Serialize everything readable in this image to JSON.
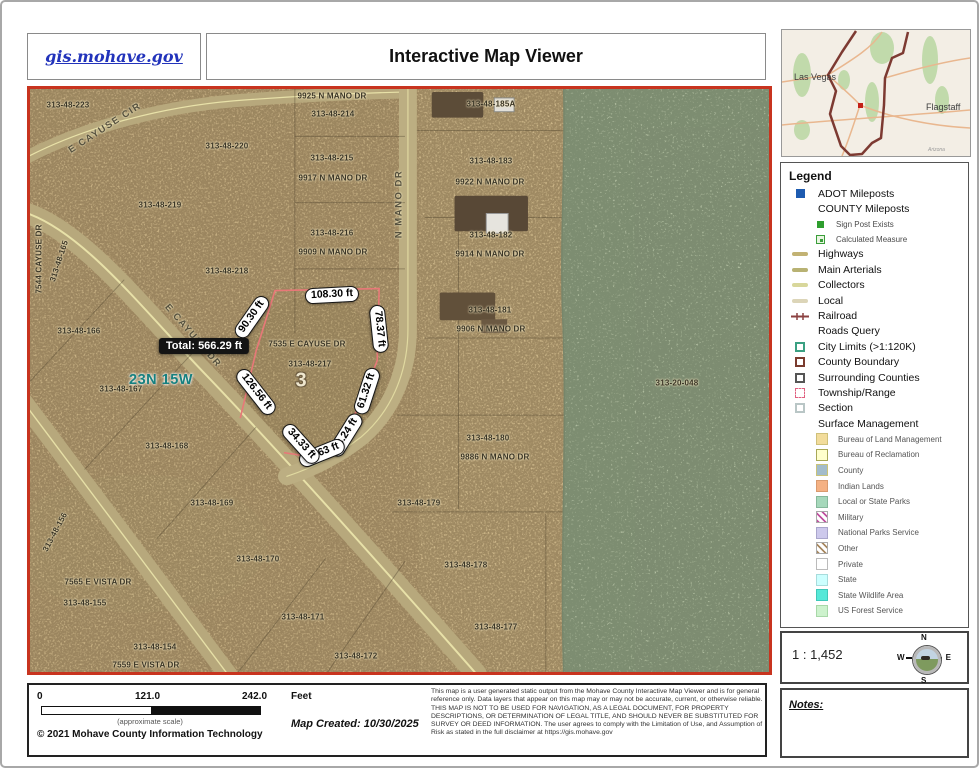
{
  "header": {
    "site_link": "gis.mohave.gov",
    "title": "Interactive Map Viewer"
  },
  "colors": {
    "map_border": "#c8341f",
    "measure_line": "#e87878",
    "link_blue": "#2233bb",
    "green_zone": "#b7c3a6",
    "township_teal": "#17807f"
  },
  "overview": {
    "las_vegas": "Las Vegas",
    "flagstaff": "Flagstaff",
    "state_note": "Arizona"
  },
  "map": {
    "township_label": "23N 15W",
    "section_number": "3",
    "measure": {
      "total": "Total: 566.29 ft",
      "segments": [
        {
          "label": "90.30 ft",
          "x": 222,
          "y": 228,
          "rot": -55
        },
        {
          "label": "108.30 ft",
          "x": 302,
          "y": 206,
          "rot": -3
        },
        {
          "label": "78.37 ft",
          "x": 349,
          "y": 240,
          "rot": 84
        },
        {
          "label": "61.32 ft",
          "x": 337,
          "y": 302,
          "rot": -72
        },
        {
          "label": "43.24 ft",
          "x": 316,
          "y": 346,
          "rot": -58
        },
        {
          "label": "22.63 ft",
          "x": 292,
          "y": 364,
          "rot": -22
        },
        {
          "label": "34.33 ft",
          "x": 271,
          "y": 355,
          "rot": 48
        },
        {
          "label": "126.56 ft",
          "x": 226,
          "y": 303,
          "rot": 52
        }
      ]
    },
    "street_labels": [
      {
        "text": "E CAYUSE CIR",
        "x": 75,
        "y": 39,
        "rot": -33
      },
      {
        "text": "E CAYUSE DR",
        "x": 163,
        "y": 247,
        "rot": 49
      },
      {
        "text": "N MANO DR",
        "x": 369,
        "y": 115,
        "rot": -90
      }
    ],
    "parcel_labels": [
      {
        "text": "313-48-223",
        "x": 38,
        "y": 16
      },
      {
        "text": "313-48-220",
        "x": 197,
        "y": 57
      },
      {
        "text": "313-48-219",
        "x": 130,
        "y": 116
      },
      {
        "text": "313-48-218",
        "x": 197,
        "y": 182
      },
      {
        "text": "9925 N MANO DR",
        "x": 302,
        "y": 7
      },
      {
        "text": "313-48-214",
        "x": 303,
        "y": 25
      },
      {
        "text": "313-48-215",
        "x": 302,
        "y": 69
      },
      {
        "text": "9917 N MANO DR",
        "x": 303,
        "y": 89
      },
      {
        "text": "313-48-216",
        "x": 302,
        "y": 144
      },
      {
        "text": "9909 N MANO DR",
        "x": 303,
        "y": 163
      },
      {
        "text": "313-48-185A",
        "x": 461,
        "y": 15
      },
      {
        "text": "313-48-183",
        "x": 461,
        "y": 72
      },
      {
        "text": "9922 N MANO DR",
        "x": 460,
        "y": 93
      },
      {
        "text": "313-48-182",
        "x": 461,
        "y": 146
      },
      {
        "text": "9914 N MANO DR",
        "x": 460,
        "y": 165
      },
      {
        "text": "313-48-181",
        "x": 460,
        "y": 221
      },
      {
        "text": "9906 N MANO DR",
        "x": 461,
        "y": 240
      },
      {
        "text": "7535 E CAYUSE DR",
        "x": 277,
        "y": 255
      },
      {
        "text": "313-48-217",
        "x": 280,
        "y": 275
      },
      {
        "text": "313-48-180",
        "x": 458,
        "y": 349
      },
      {
        "text": "9886 N MANO DR",
        "x": 465,
        "y": 368
      },
      {
        "text": "313-48-179",
        "x": 389,
        "y": 414
      },
      {
        "text": "313-20-048",
        "x": 647,
        "y": 294
      },
      {
        "text": "313-48-166",
        "x": 49,
        "y": 242
      },
      {
        "text": "313-48-167",
        "x": 91,
        "y": 300
      },
      {
        "text": "313-48-168",
        "x": 137,
        "y": 357
      },
      {
        "text": "313-48-169",
        "x": 182,
        "y": 414
      },
      {
        "text": "313-48-170",
        "x": 228,
        "y": 470
      },
      {
        "text": "7565 E VISTA DR",
        "x": 68,
        "y": 493
      },
      {
        "text": "313-48-155",
        "x": 55,
        "y": 514
      },
      {
        "text": "313-48-154",
        "x": 125,
        "y": 558
      },
      {
        "text": "7559 E VISTA DR",
        "x": 116,
        "y": 576
      },
      {
        "text": "313-48-171",
        "x": 273,
        "y": 528
      },
      {
        "text": "313-48-172",
        "x": 326,
        "y": 567
      },
      {
        "text": "313-48-178",
        "x": 436,
        "y": 476
      },
      {
        "text": "313-48-177",
        "x": 466,
        "y": 538
      },
      {
        "text": "313-48-165",
        "x": 29,
        "y": 172,
        "rot": -72
      },
      {
        "text": "7544 CAYUSE DR",
        "x": 9,
        "y": 170,
        "rot": -90
      },
      {
        "text": "313-48-156",
        "x": 25,
        "y": 443,
        "rot": -62
      }
    ]
  },
  "legend": {
    "title": "Legend",
    "items": [
      {
        "label": "ADOT Mileposts",
        "icon": "square",
        "color": "#1d5bb0"
      },
      {
        "label": "COUNTY Mileposts",
        "icon": "none"
      },
      {
        "label": "Sign Post Exists",
        "icon": "square-sm",
        "color": "#2e9e2e",
        "sub": 1
      },
      {
        "label": "Calculated Measure",
        "icon": "square-dot",
        "color": "#3a9e3a",
        "sub": 1
      },
      {
        "label": "Highways",
        "icon": "line",
        "color": "#c2b273"
      },
      {
        "label": "Main Arterials",
        "icon": "line",
        "color": "#b8b273"
      },
      {
        "label": "Collectors",
        "icon": "line",
        "color": "#d8d79b"
      },
      {
        "label": "Local",
        "icon": "line",
        "color": "#dcd5b8"
      },
      {
        "label": "Railroad",
        "icon": "rail",
        "color": "#8b4040"
      },
      {
        "label": "Roads Query",
        "icon": "none"
      },
      {
        "label": "City Limits (>1:120K)",
        "icon": "outline",
        "color": "#3aa082"
      },
      {
        "label": "County Boundary",
        "icon": "outline",
        "color": "#7a3b2e"
      },
      {
        "label": "Surrounding Counties",
        "icon": "outline",
        "color": "#555555"
      },
      {
        "label": "Township/Range",
        "icon": "outline-dash",
        "color": "#e06080"
      },
      {
        "label": "Section",
        "icon": "outline",
        "color": "#b9c6c6"
      },
      {
        "label": "Surface Management",
        "icon": "none"
      },
      {
        "label": "Bureau of Land Management",
        "icon": "swatch",
        "color": "#f2dc9b",
        "border": "#cfc07a",
        "sub": 2
      },
      {
        "label": "Bureau of Reclamation",
        "icon": "swatch",
        "color": "#ffffcc",
        "border": "#a8a858",
        "sub": 2
      },
      {
        "label": "County",
        "icon": "swatch",
        "color": "#a3bccb",
        "border": "#c9c379",
        "sub": 2
      },
      {
        "label": "Indian Lands",
        "icon": "swatch",
        "color": "#f5b183",
        "border": "#d99a6e",
        "sub": 2
      },
      {
        "label": "Local or State Parks",
        "icon": "swatch",
        "color": "#a6d8bb",
        "border": "#86b89b",
        "sub": 2
      },
      {
        "label": "Military",
        "icon": "stripes",
        "color": "#c050a0",
        "sub": 2
      },
      {
        "label": "National Parks Service",
        "icon": "swatch",
        "color": "#cdc9ec",
        "border": "#aaa6cc",
        "sub": 2
      },
      {
        "label": "Other",
        "icon": "stripes",
        "color": "#a88860",
        "sub": 2
      },
      {
        "label": "Private",
        "icon": "swatch",
        "color": "#ffffff",
        "border": "#bbbbbb",
        "sub": 2
      },
      {
        "label": "State",
        "icon": "swatch",
        "color": "#ccffff",
        "border": "#a8dcdc",
        "sub": 2
      },
      {
        "label": "State Wildlife Area",
        "icon": "swatch",
        "color": "#55e8d8",
        "border": "#3ec8b8",
        "sub": 2
      },
      {
        "label": "US Forest Service",
        "icon": "swatch",
        "color": "#cdf2cd",
        "border": "#a8d8a8",
        "sub": 2
      }
    ]
  },
  "scale_info": {
    "ratio": "1 : 1,452",
    "compass": {
      "n": "N",
      "e": "E",
      "s": "S",
      "w": "W"
    }
  },
  "notes": {
    "title": "Notes:"
  },
  "footer": {
    "ticks": [
      "0",
      "121.0",
      "242.0"
    ],
    "unit": "Feet",
    "approx": "(approximate scale)",
    "copyright": "© 2021 Mohave County Information Technology",
    "created": "Map Created: 10/30/2025",
    "disclaimer": "This map is a user generated static output from the Mohave County Interactive Map Viewer and is for general reference only. Data layers that appear on this map may or may not be accurate, current, or otherwise reliable. THIS MAP IS NOT TO BE USED FOR NAVIGATION, AS A LEGAL DOCUMENT, FOR PROPERTY DESCRIPTIONS, OR DETERMINATION OF LEGAL TITLE, AND SHOULD NEVER BE SUBSTITUTED FOR SURVEY OR DEED INFORMATION. The user agrees to comply with the Limitation of Use, and Assumption of Risk as stated in the full disclaimer at https://gis.mohave.gov"
  }
}
